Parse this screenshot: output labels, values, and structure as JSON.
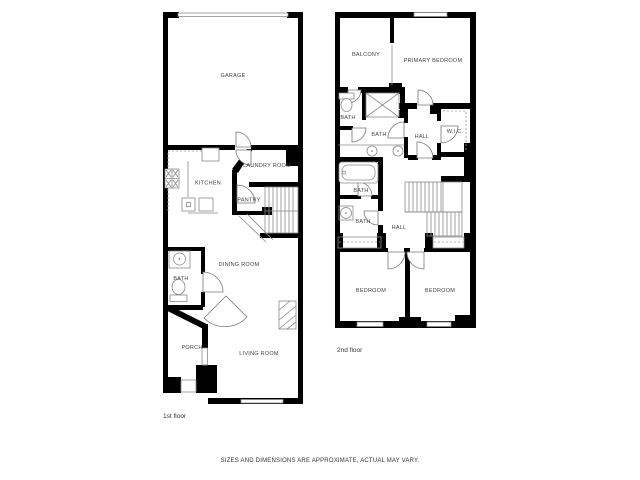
{
  "first_floor": {
    "caption": "1st floor",
    "rooms": {
      "garage": "GARAGE",
      "kitchen": "KITCHEN",
      "laundry_room": "LAUNDRY ROOM",
      "pantry": "PANTRY",
      "dining_room": "DINING ROOM",
      "bath": "BATH",
      "porch": "PORCH",
      "living_room": "LIVING ROOM"
    }
  },
  "second_floor": {
    "caption": "2nd floor",
    "rooms": {
      "balcony": "BALCONY",
      "primary_bedroom": "PRIMARY BEDROOM",
      "bath_small": "BATH",
      "bath_main": "BATH",
      "hall_upper": "HALL",
      "wic": "W.I.C.",
      "bath_tub": "BATH",
      "bath_lower": "BATH",
      "hall_lower": "HALL",
      "bedroom_left": "BEDROOM",
      "bedroom_right": "BEDROOM"
    }
  },
  "footer": {
    "disclaimer": "SIZES AND DIMENSIONS ARE APPROXIMATE, ACTUAL MAY VARY."
  },
  "colors": {
    "wall": "#000000",
    "fixture_line": "#8a8a8a",
    "label_text": "#444444",
    "background": "#ffffff"
  }
}
